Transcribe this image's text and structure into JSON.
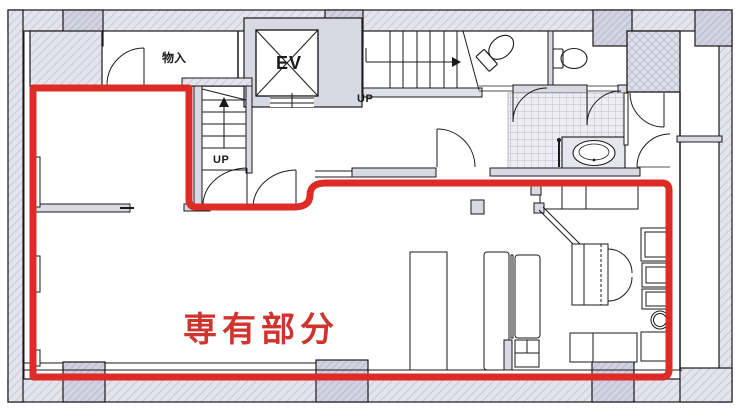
{
  "title": "floor-plan",
  "labels": {
    "storage": "物入",
    "elevator": "EV",
    "stairs_up": "UP",
    "inner_stairs_up": "UP",
    "exclusive_area": "専有部分"
  },
  "colors": {
    "outline_red": "#dd2b25",
    "exclusive_label_red": "#d0342e",
    "wall_fill": "#e4e4ed",
    "wall_hatch_line": "#c9c9d8",
    "pillar_fill": "#d2d2e0",
    "pillar_hatch_line": "#b9b9cc",
    "line_black": "#1a1a1a",
    "tile_fill": "#ededf3",
    "tile_line": "#bdbdcb"
  }
}
